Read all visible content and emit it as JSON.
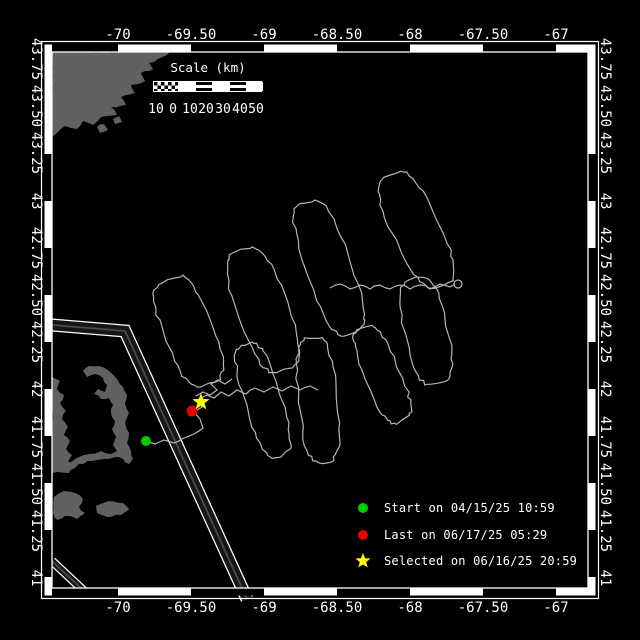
{
  "figure": {
    "width": 640,
    "height": 640,
    "background": "#000000"
  },
  "colors": {
    "frame": "#ffffff",
    "text": "#ffffff",
    "land": "#616161",
    "track": "#b5b5b5",
    "lane_fill": "#161616",
    "lane_stripe": "#4a4a4a",
    "lane_edge": "#ffffff"
  },
  "axes": {
    "lon_ticks": [
      {
        "label": "-70",
        "px": 118
      },
      {
        "label": "-69.50",
        "px": 191
      },
      {
        "label": "-69",
        "px": 264
      },
      {
        "label": "-68.50",
        "px": 337
      },
      {
        "label": "-68",
        "px": 410
      },
      {
        "label": "-67.50",
        "px": 483
      },
      {
        "label": "-67",
        "px": 556
      }
    ],
    "lat_ticks": [
      {
        "label": "43.75",
        "px": 59
      },
      {
        "label": "43.50",
        "px": 106
      },
      {
        "label": "43.25",
        "px": 153
      },
      {
        "label": "43",
        "px": 201
      },
      {
        "label": "42.75",
        "px": 248
      },
      {
        "label": "42.50",
        "px": 295
      },
      {
        "label": "42.25",
        "px": 342
      },
      {
        "label": "42",
        "px": 389
      },
      {
        "label": "41.75",
        "px": 437
      },
      {
        "label": "41.50",
        "px": 484
      },
      {
        "label": "41.25",
        "px": 531
      },
      {
        "label": "41",
        "px": 578
      }
    ],
    "band": {
      "top_black": [
        [
          52,
          118
        ],
        [
          191,
          264
        ],
        [
          337,
          410
        ],
        [
          483,
          556
        ]
      ],
      "side_black": [
        [
          154,
          201
        ],
        [
          248,
          295
        ],
        [
          342,
          389
        ],
        [
          436,
          483
        ],
        [
          530,
          577
        ]
      ]
    },
    "frame_rect": {
      "inner": [
        52,
        52,
        536,
        536
      ],
      "band": [
        48,
        48,
        544,
        544
      ],
      "outer": [
        41.5,
        41.5,
        557,
        557
      ]
    }
  },
  "scalebar": {
    "title": "Scale (km)",
    "labels": [
      {
        "text": "10",
        "x": 16
      },
      {
        "text": "0",
        "x": 33
      },
      {
        "text": "10",
        "x": 50
      },
      {
        "text": "20",
        "x": 66
      },
      {
        "text": "30",
        "x": 83
      },
      {
        "text": "40",
        "x": 100
      },
      {
        "text": "50",
        "x": 116
      }
    ],
    "segments": [
      {
        "left": 24,
        "width": 17,
        "style": "white"
      },
      {
        "left": 41,
        "width": 17,
        "style": "stripe"
      },
      {
        "left": 58,
        "width": 17,
        "style": "white"
      },
      {
        "left": 75,
        "width": 17,
        "style": "stripe"
      },
      {
        "left": 92,
        "width": 17,
        "style": "white"
      }
    ]
  },
  "legend": {
    "items": [
      {
        "marker": "circle",
        "color": "#00cc00",
        "label": "Start on 04/15/25 10:59",
        "row_top": 500
      },
      {
        "marker": "circle",
        "color": "#e60000",
        "label": "Last on 06/17/25 05:29",
        "row_top": 527
      },
      {
        "marker": "star",
        "color": "#ffff00",
        "label": "Selected on 06/16/25 20:59",
        "row_top": 553
      }
    ],
    "left": 355
  },
  "map": {
    "land": [
      {
        "name": "maine-coast",
        "points": [
          [
            52,
            52
          ],
          [
            170,
            52
          ],
          [
            158,
            59
          ],
          [
            149,
            63
          ],
          [
            153,
            69
          ],
          [
            141,
            73
          ],
          [
            145,
            81
          ],
          [
            131,
            85
          ],
          [
            135,
            93
          ],
          [
            121,
            97
          ],
          [
            126,
            105
          ],
          [
            111,
            107
          ],
          [
            117,
            115
          ],
          [
            101,
            117
          ],
          [
            93,
            125
          ],
          [
            83,
            121
          ],
          [
            77,
            129
          ],
          [
            65,
            126
          ],
          [
            57,
            133
          ],
          [
            52,
            137
          ]
        ]
      },
      {
        "name": "island-1",
        "points": [
          [
            97,
            127
          ],
          [
            104,
            124
          ],
          [
            108,
            130
          ],
          [
            100,
            133
          ]
        ]
      },
      {
        "name": "island-2",
        "points": [
          [
            113,
            119
          ],
          [
            119,
            116
          ],
          [
            122,
            122
          ],
          [
            115,
            124
          ]
        ]
      },
      {
        "name": "mass-shore",
        "points": [
          [
            52,
            377
          ],
          [
            60,
            381
          ],
          [
            57,
            389
          ],
          [
            64,
            395
          ],
          [
            60,
            403
          ],
          [
            66,
            411
          ],
          [
            62,
            419
          ],
          [
            68,
            427
          ],
          [
            64,
            435
          ],
          [
            70,
            441
          ],
          [
            66,
            449
          ],
          [
            72,
            455
          ],
          [
            68,
            461
          ],
          [
            74,
            467
          ],
          [
            69,
            473
          ],
          [
            52,
            473
          ]
        ]
      },
      {
        "name": "cape-cod",
        "points": [
          [
            69,
            471
          ],
          [
            79,
            464
          ],
          [
            92,
            461
          ],
          [
            104,
            459
          ],
          [
            115,
            457
          ],
          [
            123,
            459
          ],
          [
            129,
            464
          ],
          [
            133,
            459
          ],
          [
            131,
            451
          ],
          [
            127,
            443
          ],
          [
            129,
            433
          ],
          [
            125,
            423
          ],
          [
            129,
            413
          ],
          [
            125,
            403
          ],
          [
            127,
            395
          ],
          [
            123,
            387
          ],
          [
            117,
            379
          ],
          [
            109,
            371
          ],
          [
            99,
            366
          ],
          [
            89,
            366
          ],
          [
            83,
            371
          ],
          [
            87,
            377
          ],
          [
            95,
            374
          ],
          [
            103,
            378
          ],
          [
            107,
            385
          ],
          [
            105,
            392
          ],
          [
            98,
            389
          ],
          [
            94,
            394
          ],
          [
            101,
            399
          ],
          [
            109,
            398
          ],
          [
            113,
            405
          ],
          [
            111,
            413
          ],
          [
            115,
            421
          ],
          [
            112,
            429
          ],
          [
            116,
            437
          ],
          [
            113,
            445
          ],
          [
            117,
            451
          ],
          [
            111,
            454
          ],
          [
            101,
            451
          ],
          [
            89,
            454
          ],
          [
            79,
            457
          ],
          [
            70,
            463
          ]
        ]
      },
      {
        "name": "marthas-vineyard",
        "points": [
          [
            54,
            497
          ],
          [
            64,
            491
          ],
          [
            75,
            493
          ],
          [
            83,
            499
          ],
          [
            79,
            507
          ],
          [
            85,
            513
          ],
          [
            77,
            519
          ],
          [
            65,
            516
          ],
          [
            57,
            520
          ],
          [
            53,
            513
          ]
        ]
      },
      {
        "name": "nantucket",
        "points": [
          [
            96,
            506
          ],
          [
            109,
            501
          ],
          [
            123,
            503
          ],
          [
            129,
            509
          ],
          [
            121,
            515
          ],
          [
            107,
            517
          ],
          [
            97,
            513
          ]
        ]
      }
    ],
    "lanes": [
      {
        "name": "traffic-lane-main",
        "points": [
          [
            52,
            325
          ],
          [
            125,
            331
          ],
          [
            247,
            599
          ]
        ],
        "width": 13
      },
      {
        "name": "traffic-lane-fragment",
        "points": [
          [
            52,
            561
          ],
          [
            84,
            591
          ]
        ],
        "width": 9
      }
    ],
    "track": {
      "loops": [
        {
          "t": [
            168,
            279
          ],
          "b": [
            209,
            384
          ],
          "w": 24
        },
        {
          "t": [
            241,
            250
          ],
          "b": [
            285,
            370
          ],
          "w": 25
        },
        {
          "t": [
            306,
            202
          ],
          "b": [
            352,
            333
          ],
          "w": 22
        },
        {
          "t": [
            390,
            175
          ],
          "b": [
            443,
            286
          ],
          "w": 23
        },
        {
          "t": [
            312,
            338
          ],
          "b": [
            324,
            462
          ],
          "w": 19
        },
        {
          "t": [
            363,
            328
          ],
          "b": [
            402,
            421
          ],
          "w": 17
        },
        {
          "t": [
            414,
            278
          ],
          "b": [
            438,
            384
          ],
          "w": 21
        },
        {
          "t": [
            246,
            344
          ],
          "b": [
            280,
            456
          ],
          "w": 18
        }
      ],
      "paths": [
        [
          [
            146,
            441
          ],
          [
            155,
            444
          ],
          [
            164,
            440
          ],
          [
            174,
            443
          ],
          [
            184,
            438
          ],
          [
            194,
            434
          ],
          [
            203,
            428
          ],
          [
            200,
            419
          ],
          [
            194,
            412
          ],
          [
            202,
            407
          ],
          [
            199,
            399
          ],
          [
            207,
            395
          ],
          [
            214,
            398
          ],
          [
            221,
            392
          ],
          [
            229,
            396
          ],
          [
            237,
            390
          ],
          [
            246,
            394
          ],
          [
            255,
            388
          ],
          [
            264,
            392
          ],
          [
            273,
            387
          ],
          [
            282,
            391
          ],
          [
            291,
            386
          ],
          [
            300,
            390
          ],
          [
            310,
            386
          ],
          [
            318,
            390
          ]
        ],
        [
          [
            330,
            288
          ],
          [
            340,
            284
          ],
          [
            350,
            289
          ],
          [
            360,
            285
          ],
          [
            370,
            289
          ],
          [
            380,
            285
          ],
          [
            390,
            289
          ],
          [
            400,
            285
          ],
          [
            410,
            289
          ],
          [
            420,
            285
          ],
          [
            430,
            289
          ],
          [
            440,
            284
          ],
          [
            450,
            287
          ],
          [
            455,
            284
          ]
        ],
        [
          [
            196,
            396
          ],
          [
            203,
            392
          ],
          [
            210,
            395
          ],
          [
            217,
            390
          ],
          [
            211,
            384
          ],
          [
            218,
            380
          ],
          [
            225,
            384
          ],
          [
            232,
            379
          ]
        ]
      ],
      "blob": {
        "cx": 458,
        "cy": 284,
        "r": 4
      }
    },
    "markers": {
      "start": {
        "x": 146,
        "y": 441,
        "r": 5,
        "color": "#00cc00"
      },
      "last": {
        "x": 192,
        "y": 411,
        "r": 5.5,
        "color": "#e60000"
      },
      "selected": {
        "x": 201,
        "y": 402,
        "r": 9,
        "color": "#ffff00"
      }
    }
  }
}
